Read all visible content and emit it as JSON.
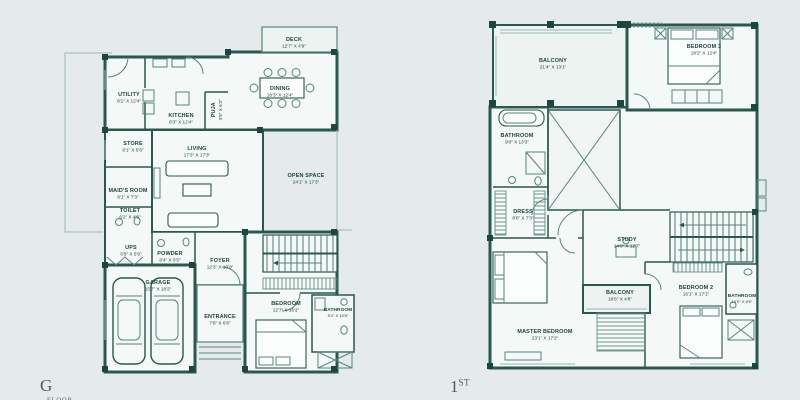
{
  "colors": {
    "background": "#e4ebea",
    "wall": "#2a574f",
    "thin_line": "#57847e",
    "light_line": "#9cb8b3",
    "room_fill": "#f4f8f6",
    "text": "#1c443f"
  },
  "ground": {
    "floor_label": "G",
    "floor_word": "FLOOR",
    "rooms": [
      {
        "name": "DECK",
        "dims": "12'7\" X 4'9\""
      },
      {
        "name": "UTILITY",
        "dims": "8'1\" X 12'4\""
      },
      {
        "name": "KITCHEN",
        "dims": "8'3\" X 12'4\""
      },
      {
        "name": "PUJA",
        "dims": "3'8\" X 6'2\""
      },
      {
        "name": "DINING",
        "dims": "18'3\" X 12'4\""
      },
      {
        "name": "STORE",
        "dims": "8'1\" X 5'6\""
      },
      {
        "name": "LIVING",
        "dims": "17'3\" X 17'3\""
      },
      {
        "name": "OPEN SPACE",
        "dims": "24'1\" X 17'3\""
      },
      {
        "name": "MAID'S ROOM",
        "dims": "6'1\" X 7'3\""
      },
      {
        "name": "TOILET",
        "dims": "6'2\" X 4'6\""
      },
      {
        "name": "UPS",
        "dims": "6'9\" X 5'9\""
      },
      {
        "name": "POWDER",
        "dims": "8'4\" X 5'5\""
      },
      {
        "name": "FOYER",
        "dims": "12'3\" X 10'0\""
      },
      {
        "name": "GARAGE",
        "dims": "15'7\" X 18'2\""
      },
      {
        "name": "ENTRANCE",
        "dims": "7'8\" X 6'8\""
      },
      {
        "name": "BEDROOM",
        "dims": "12'7\" X 16'2\""
      },
      {
        "name": "BATHROOM",
        "dims": "5'4\" X 10'8\""
      }
    ]
  },
  "first": {
    "floor_label": "1",
    "floor_suffix": "ST",
    "rooms": [
      {
        "name": "BALCONY",
        "dims": "21'4\" X 13'1\""
      },
      {
        "name": "BEDROOM 3",
        "dims": "18'2\" X 12'4\""
      },
      {
        "name": "BATHROOM",
        "dims": "9'0\" X 13'3\""
      },
      {
        "name": "DRESS",
        "dims": "8'0\" X 7'3\""
      },
      {
        "name": "STUDY",
        "dims": "14'0\" X 12'7\""
      },
      {
        "name": "BALCONY",
        "dims": "16'6\" X 4'8\""
      },
      {
        "name": "BEDROOM 2",
        "dims": "16'1\" X 17'1\""
      },
      {
        "name": "BATHROOM",
        "dims": "10'0\" X 6'6\""
      },
      {
        "name": "MASTER BEDROOM",
        "dims": "23'1\" X 17'2\""
      }
    ]
  }
}
